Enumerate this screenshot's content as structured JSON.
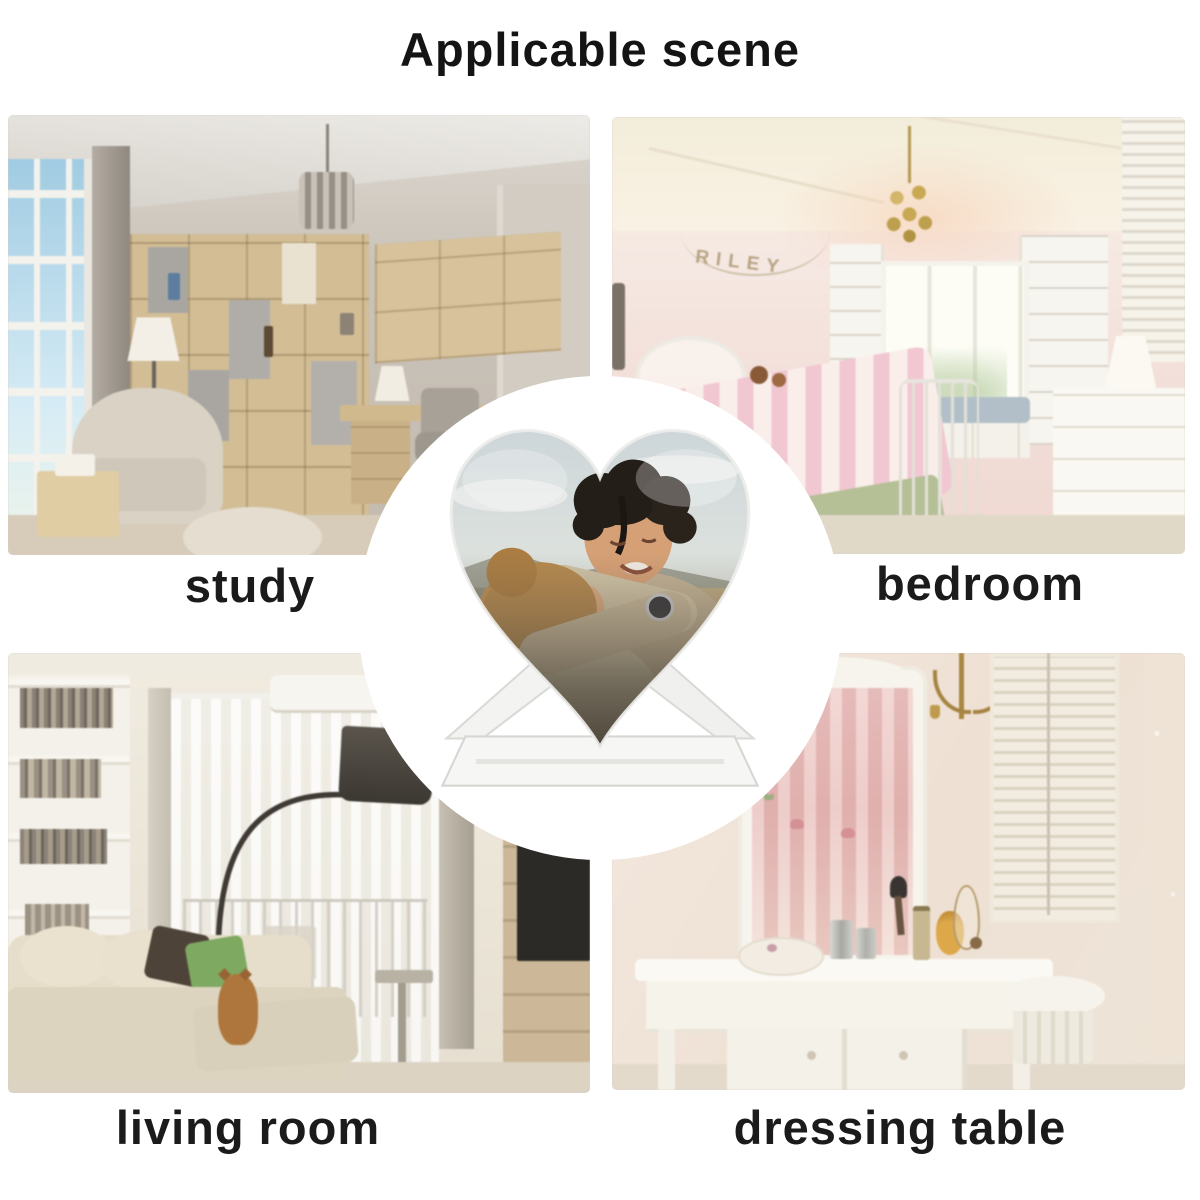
{
  "title": "Applicable scene",
  "scenes": [
    {
      "id": "study",
      "label": "study"
    },
    {
      "id": "bedroom",
      "label": "bedroom",
      "wall_banner_text": "RILEY"
    },
    {
      "id": "living-room",
      "label": "living room"
    },
    {
      "id": "dressing-table",
      "label": "dressing table"
    }
  ],
  "center_product": {
    "icon": "heart-photo-frame",
    "subject": "hugging couple photo in heart-shaped crystal on clear stand"
  },
  "colors": {
    "page_background": "#ffffff",
    "highlight_circle": "#ffffff",
    "label_text": "#1b1b1b"
  }
}
